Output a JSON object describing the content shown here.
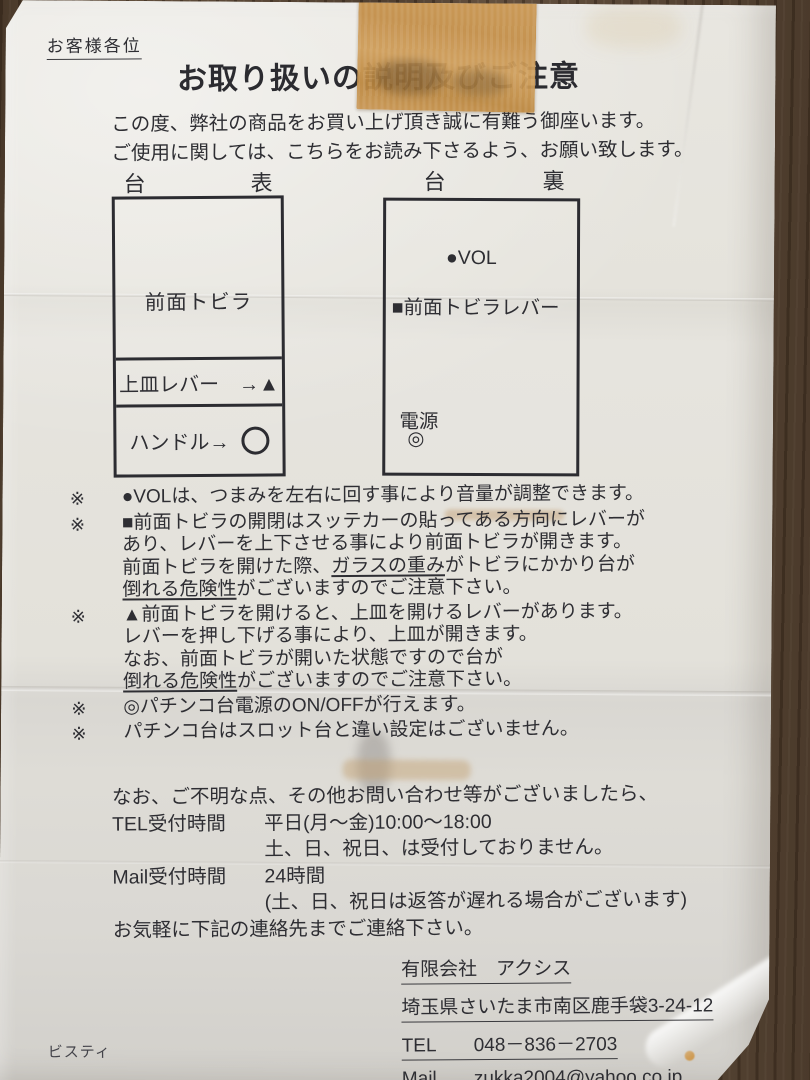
{
  "colors": {
    "wood": "#63503e",
    "paper": "#e6e4dd",
    "tape": "#c3914c",
    "ink": "#2e2e33"
  },
  "header": {
    "salutation": "お客様各位",
    "title": "お取り扱いの説明及びご注意"
  },
  "intro": {
    "line1": "この度、弊社の商品をお買い上げ頂き誠に有難う御座います。",
    "line2": "ご使用に関しては、こちらをお読み下さるよう、お願い致します。"
  },
  "diagrams": {
    "front": {
      "header_left": "台",
      "header_right": "表",
      "door_label": "前面トビラ",
      "tray_lever_label": "上皿レバー　→▲",
      "handle_label": "ハンドル→",
      "handle_symbol_icon": "circle-outline"
    },
    "back": {
      "header_left": "台",
      "header_right": "裏",
      "vol_label": "●VOL",
      "door_lever_label": "■前面トビラレバー",
      "power_label": "電源",
      "power_symbol": "◎"
    }
  },
  "notes": [
    {
      "marker": "※",
      "lines": [
        [
          {
            "t": "●VOLは、つまみを左右に回す事により音量が調整できます。"
          }
        ]
      ]
    },
    {
      "marker": "※",
      "lines": [
        [
          {
            "t": "■前面トビラの開閉はスッテカーの貼ってある方向にレバーが"
          }
        ],
        [
          {
            "t": "あり、レバーを上下させる事により前面トビラが開きます。"
          }
        ],
        [
          {
            "t": "前面トビラを開けた際、"
          },
          {
            "t": "ガラスの重み",
            "u": true
          },
          {
            "t": "がトビラにかかり台が"
          }
        ],
        [
          {
            "t": "倒れる危険性",
            "u": true
          },
          {
            "t": "がございますのでご注意下さい。"
          }
        ]
      ]
    },
    {
      "marker": "※",
      "lines": [
        [
          {
            "t": "▲前面トビラを開けると、上皿を開けるレバーがあります。"
          }
        ],
        [
          {
            "t": "レバーを押し下げる事により、上皿が開きます。"
          }
        ],
        [
          {
            "t": "なお、前面トビラが開いた状態ですので台が"
          }
        ],
        [
          {
            "t": "倒れる危険性",
            "u": true
          },
          {
            "t": "がございますのでご注意下さい。"
          }
        ]
      ]
    },
    {
      "marker": "※",
      "lines": [
        [
          {
            "t": "◎パチンコ台電源のON/OFFが行えます。"
          }
        ]
      ]
    },
    {
      "marker": "※",
      "lines": [
        [
          {
            "t": "パチンコ台はスロット台と違い設定はございません。"
          }
        ]
      ]
    }
  ],
  "contact": {
    "intro": "なお、ご不明な点、その他お問い合わせ等がございましたら、",
    "tel_label": "TEL受付時間",
    "tel_hours": "平日(月～金)10:00～18:00",
    "tel_closed": "土、日、祝日、は受付しておりません。",
    "mail_label": "Mail受付時間",
    "mail_hours": "24時間",
    "mail_note": "(土、日、祝日は返答が遅れる場合がございます)",
    "closing": "お気軽に下記の連絡先までご連絡下さい。"
  },
  "company": {
    "name": "有限会社　アクシス",
    "address": "埼玉県さいたま市南区鹿手袋3-24-12",
    "tel_label": "TEL",
    "tel_number": "048－836－2703",
    "mail_label": "Mail",
    "mail_address": "zukka2004@yahoo.co.jp"
  },
  "footer": {
    "brand": "ビスティ"
  }
}
